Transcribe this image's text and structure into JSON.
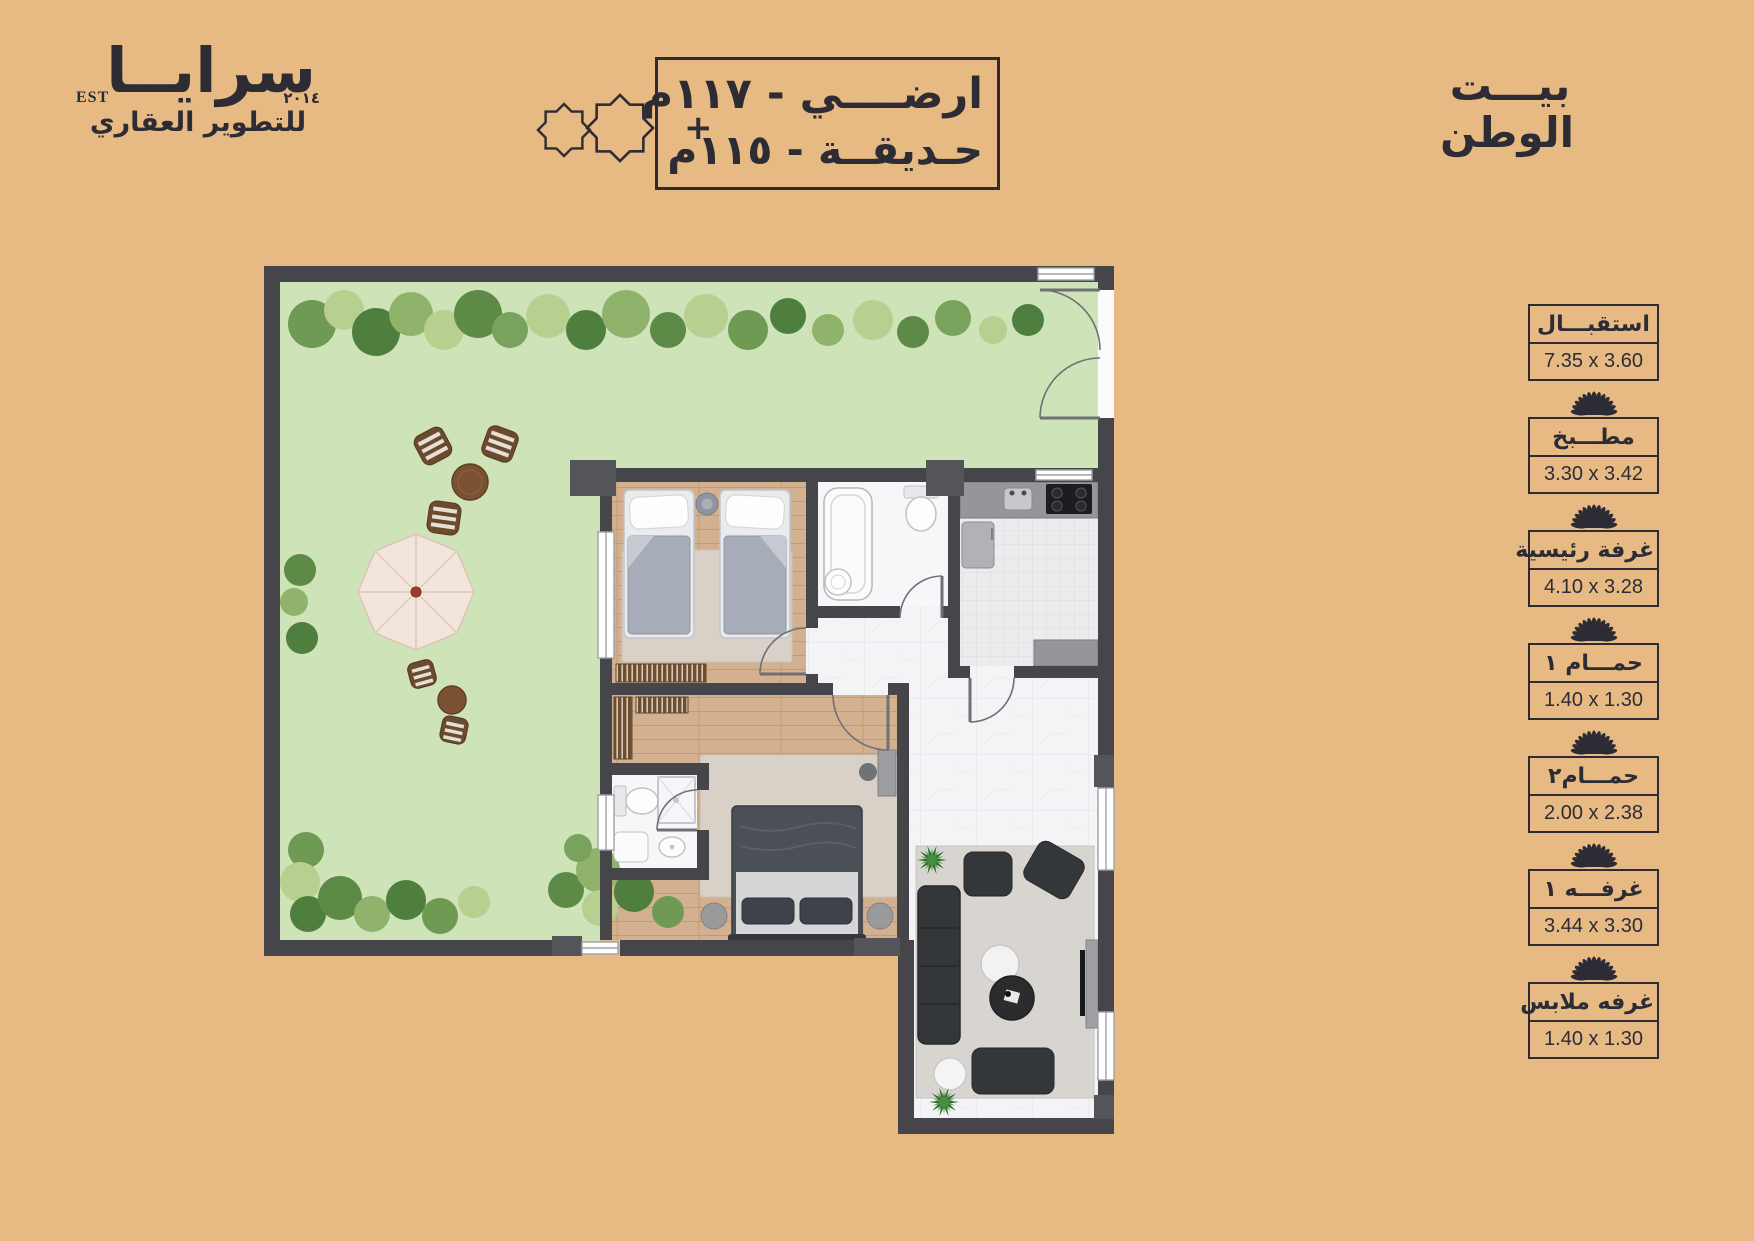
{
  "colors": {
    "background": "#e7ba84",
    "ink": "#2d2c35",
    "wall": "#46464a",
    "garden": "#cfe3b8",
    "wood": "#d3b190",
    "marble": "#f4f4f6"
  },
  "logo": {
    "name": "سرايــا",
    "est": "EST",
    "year": "٢٠١٤",
    "tagline": "للتطوير العقاري"
  },
  "header_box": {
    "line1": "ارضــــي - ١١٧م",
    "line2": "حـديقــة - ١١٥م",
    "plus": "+"
  },
  "brand": {
    "line1": "بيـــت",
    "line2": "الوطن"
  },
  "legend": {
    "items": [
      {
        "name": "استقبـــال",
        "dims": "7.35 x 3.60"
      },
      {
        "name": "مطـــبخ",
        "dims": "3.30 x 3.42"
      },
      {
        "name": "غرفة رئيسية",
        "dims": "4.10 x 3.28"
      },
      {
        "name": "حمـــام ١",
        "dims": "1.40 x 1.30"
      },
      {
        "name": "حمـــام٢",
        "dims": "2.00 x 2.38"
      },
      {
        "name": "غرفـــه ١",
        "dims": "3.44 x 3.30"
      },
      {
        "name": "غرفه ملابس",
        "dims": "1.40 x 1.30"
      }
    ]
  }
}
